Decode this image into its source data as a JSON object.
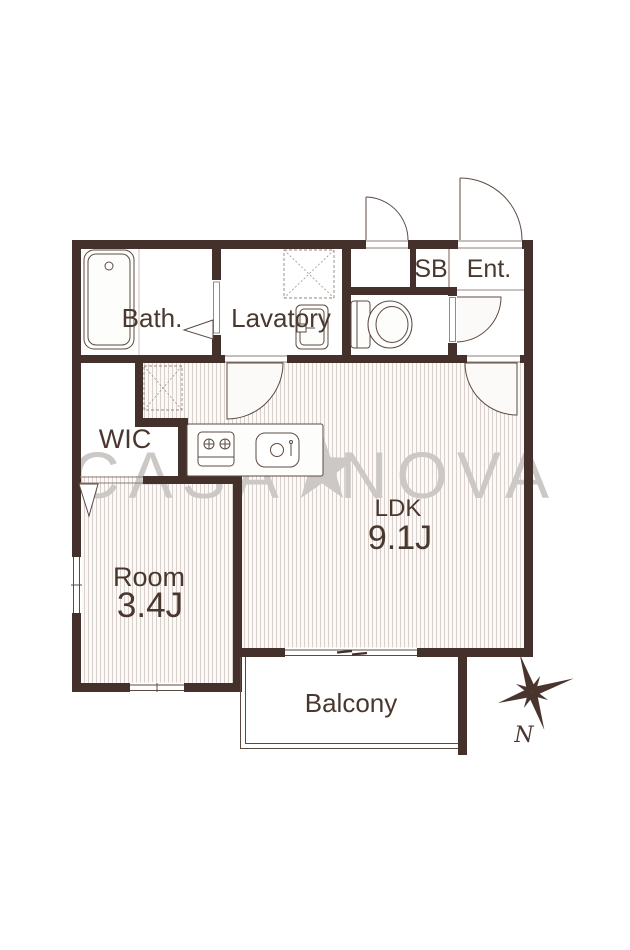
{
  "floorplan": {
    "watermark": {
      "part1": "CASA",
      "part2": "NOVA",
      "star_icon": "star",
      "color": "#cbc8c5"
    },
    "rooms": {
      "bath": {
        "label": "Bath."
      },
      "lavatory": {
        "label": "Lavatory"
      },
      "shoe_box": {
        "label": "SB"
      },
      "entrance": {
        "label": "Ent."
      },
      "wic": {
        "label": "WIC"
      },
      "ldk": {
        "label": "LDK",
        "area": "9.1J"
      },
      "room": {
        "label": "Room",
        "area": "3.4J"
      },
      "balcony": {
        "label": "Balcony"
      }
    },
    "compass": {
      "north_label": "N"
    },
    "colors": {
      "wall": "#45312b",
      "label_text": "#4a382f",
      "fixture_line": "#5c4a42",
      "floor_hatch": "#d9d0cb",
      "floor_bg": "#fcfaf9",
      "watermark": "#cbc8c5"
    }
  }
}
